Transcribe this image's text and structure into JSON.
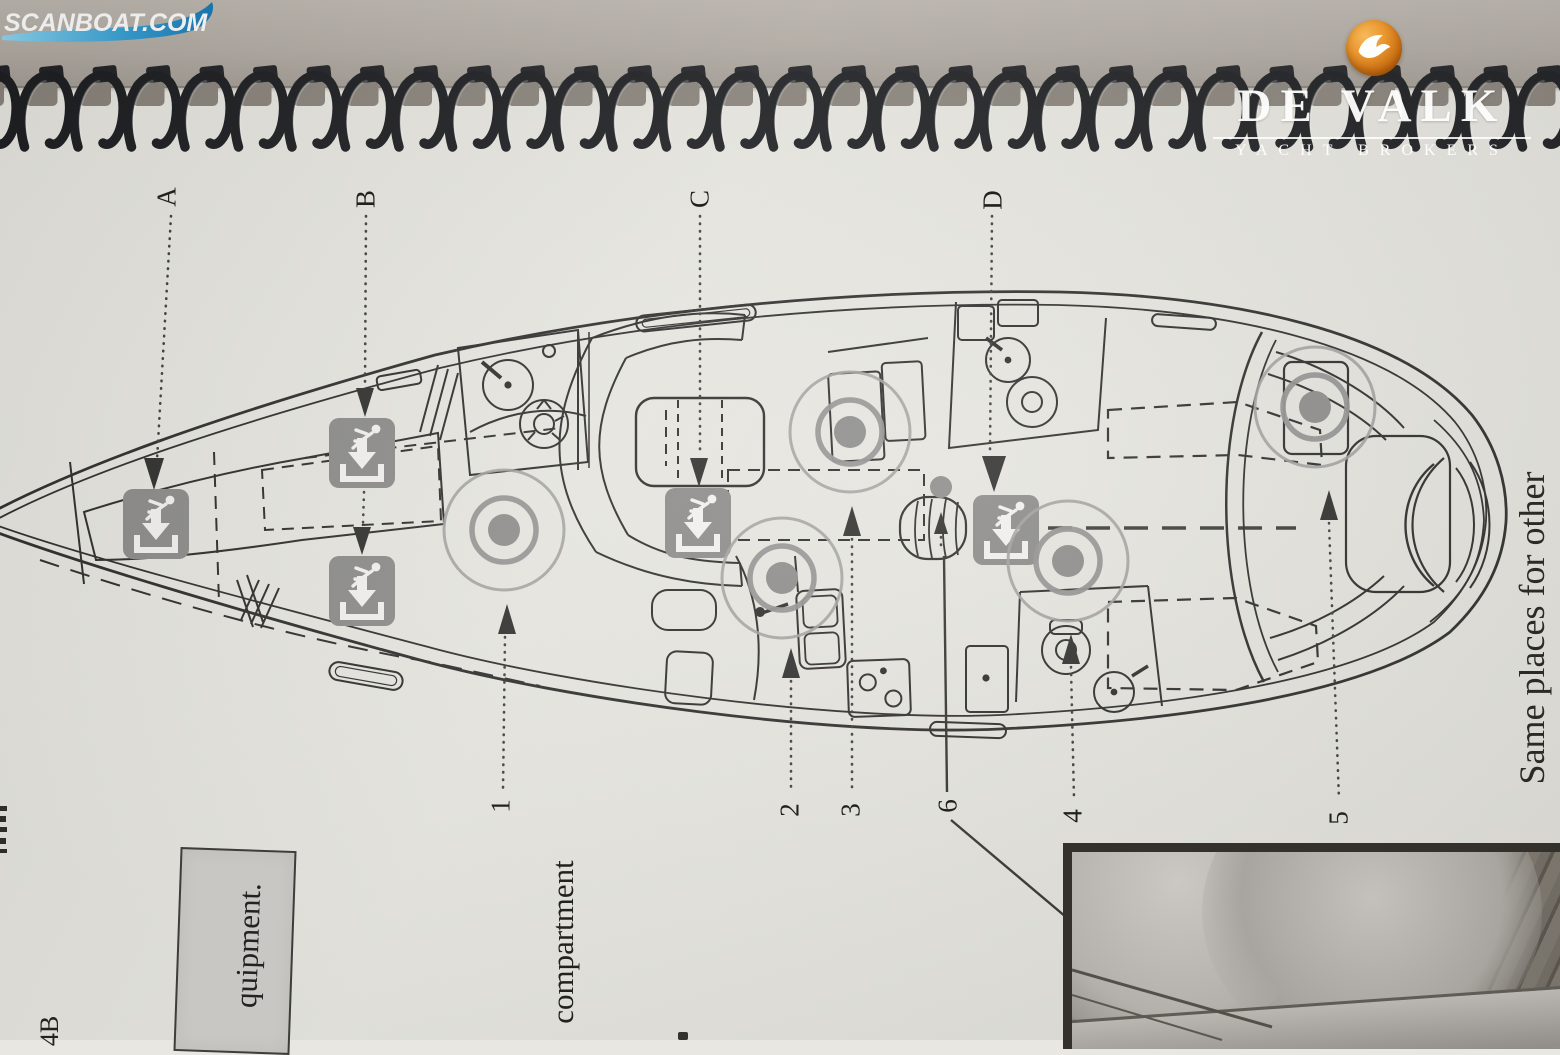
{
  "page": {
    "binding": {
      "coil_count": 30
    },
    "brand": {
      "name": "DE VALK",
      "tagline": "YACHT BROKERS",
      "logo_icon": "falcon-logo-icon",
      "logo_orange": "#d9821e"
    },
    "diagram": {
      "type": "yacht-deck-safety-plan",
      "callouts": {
        "A": "A",
        "B": "B",
        "C": "C",
        "D": "D"
      },
      "numbers": {
        "n1": "1",
        "n2": "2",
        "n3": "3",
        "n4": "4",
        "n5": "5",
        "n6": "6"
      },
      "texts": {
        "bottom_note": "compartment",
        "right_note": "Same places for other",
        "left_box_note": "quipment.",
        "corner_note": "4B"
      },
      "icons": {
        "escape_hatch": "escape-hatch-icon",
        "safety_marker": "safety-point-marker"
      },
      "colors": {
        "line": "#2e2d2b",
        "icon_gray": "#8d8c8a",
        "marker_gray": "#8f8e8c",
        "paper": "#e8e7e1",
        "desk": "#b3ada5"
      }
    },
    "watermark": {
      "text": "SCANBOAT.COM",
      "wave_color": "#2e9fd6"
    }
  }
}
